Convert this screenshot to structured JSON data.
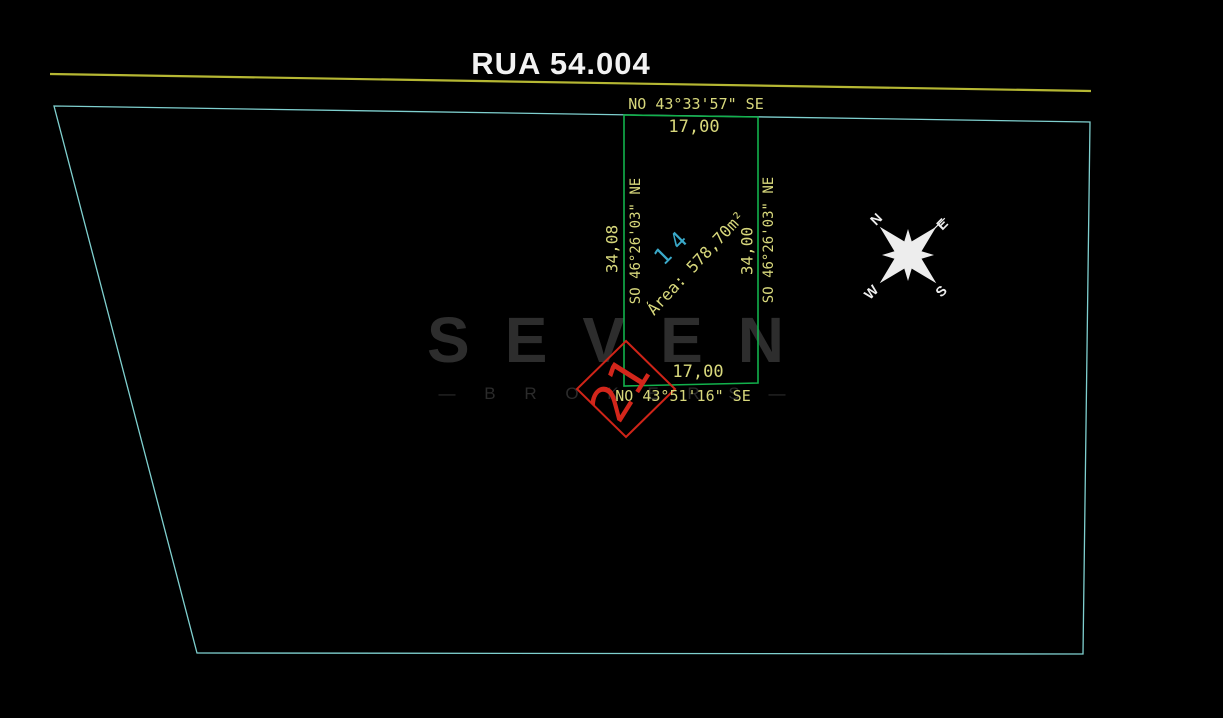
{
  "title": "RUA 54.004",
  "parcel": {
    "lot_number": "14",
    "area_label": "Área: 578,70m²",
    "sides": {
      "front": {
        "bearing": "NO 43°33'57\" SE",
        "length": "17,00"
      },
      "back": {
        "bearing": "NO 43°51'16\" SE",
        "length": "17,00"
      },
      "left": {
        "bearing": "SO 46°26'03\" NE",
        "length": "34,08"
      },
      "right": {
        "bearing": "SO 46°26'03\" NE",
        "length": "34,00"
      }
    }
  },
  "block_marker": {
    "number": "21"
  },
  "compass": {
    "north": "N",
    "east": "E",
    "south": "S",
    "west": "W"
  },
  "watermark": {
    "brand": "SEVEN",
    "subtitle": "— B R O K E R S —"
  },
  "colors": {
    "background": "#000000",
    "boundary_line": "#7fd0cf",
    "street_line": "#b5b733",
    "lot_line": "#12b14c",
    "annotation_text": "#d8d87c",
    "lot_number_text": "#3aa9c9",
    "block_marker": "#d3261b",
    "title_text": "#f2f2f2",
    "compass": "#ededed",
    "watermark": "#2d2d2d"
  }
}
